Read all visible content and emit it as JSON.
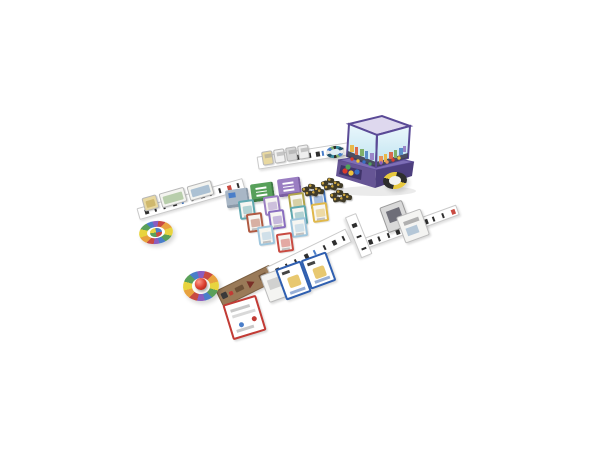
{
  "scene": {
    "name": "board-game-tabletop-setup",
    "background": "#ffffff"
  },
  "tower": {
    "name": "ball-dispenser-tower",
    "frame": "#5a4a96",
    "rim_inner": "#ded8ee",
    "base_top": "#7d6eb5",
    "base_front": "#665595",
    "base_side": "#4d3f7e",
    "tray": "#3f3469",
    "sky_top": "#eaf7fc",
    "sky_bottom": "#bfe3f0",
    "skyline_base": "#3d3d52",
    "building_colors": [
      "#e8b94a",
      "#d96a4e",
      "#7fb069",
      "#5b8fc9",
      "#9a86c8",
      "#e8945a"
    ],
    "tray_balls": [
      "#d93a2b",
      "#f0c33c",
      "#3a6fc4",
      "#4fa05a"
    ],
    "inner_balls": [
      "#d93a2b",
      "#f0c33c",
      "#3a6fc4",
      "#4fa05a",
      "#8a5ec0",
      "#e8945a"
    ]
  },
  "market": {
    "decks": [
      {
        "name": "deck-gray",
        "top": "#a9b7c6",
        "side": "#8b99a8",
        "mark": "#4a7ec9"
      },
      {
        "name": "deck-green",
        "top": "#57a05a",
        "side": "#3f7a44",
        "mark": "#ffffff"
      },
      {
        "name": "deck-purple",
        "top": "#9a7ec2",
        "side": "#7a5fa2",
        "mark": "#ffffff"
      }
    ],
    "card_face": "#f7f6f2",
    "card_borders": [
      "#5fa8b0",
      "#9a7ec2",
      "#b0a44a",
      "#4a7ec9",
      "#b05a42",
      "#8a6ec0",
      "#5fa8b0",
      "#e0b84a",
      "#9fc6dd",
      "#9fc6dd",
      "#c94b42"
    ]
  },
  "tokens": {
    "name": "resource-token-piles",
    "base": "#3f3a28",
    "accent": "#c8a23f"
  },
  "discs": [
    {
      "name": "player-disc-teal",
      "ring": [
        "#3a8fa0",
        "#24536b",
        "#e8e8e8",
        "#4a7ec9",
        "#7fb069",
        "#2e2e2e"
      ],
      "center": "#dfeef5"
    },
    {
      "name": "player-disc-yellow",
      "ring": [
        "#2e2e2e",
        "#e8c93f"
      ],
      "center": "#f3f3f0"
    },
    {
      "name": "player-disc-wheel",
      "ring": [
        "#c94b42",
        "#e8a23f",
        "#e8d43f",
        "#5aa05a",
        "#4a7ec9",
        "#8a5ec0"
      ],
      "center": "#ffffff",
      "pie": [
        "#4a7ec9",
        "#c94b42",
        "#5aa05a",
        "#e8d43f"
      ]
    },
    {
      "name": "player-disc-marble",
      "ring": [
        "#c94b42",
        "#e8a23f",
        "#e8d43f",
        "#5aa05a",
        "#4a7ec9",
        "#8a5ec0"
      ],
      "center": "#fbfbf8",
      "marble": "#d93a2b"
    }
  ],
  "strips": {
    "board": "#ffffff",
    "edge": "#c9c9c9",
    "tick": "#2e2e2e",
    "tick_accents": [
      "#c94b42",
      "#4a7ec9",
      "#5aa05a"
    ],
    "brown": "#9a7a58",
    "brown_dark": "#6e5238",
    "arrow": "#7a3028"
  },
  "strip_cards": {
    "top_faces": [
      "#e8d8a0",
      "#f2f2f2",
      "#d8d8d8",
      "#efefef"
    ],
    "left_faces": [
      "#e8d8a0",
      "#f4f4f0",
      "#f4f4f0"
    ],
    "left_art": [
      "#c8b060",
      "#a9c49a",
      "#9ab4cc"
    ]
  },
  "player_cards": {
    "red": {
      "border": "#c23b35",
      "face": "#ffffff"
    },
    "blue": {
      "border": "#2f5fb0",
      "face": "#ffffff",
      "art": "#e8c870"
    },
    "white": {
      "border": "#bbbbbb",
      "face": "#f4f4f2"
    },
    "gray": {
      "border": "#9a9a9a",
      "face": "#d9d9d9"
    }
  }
}
